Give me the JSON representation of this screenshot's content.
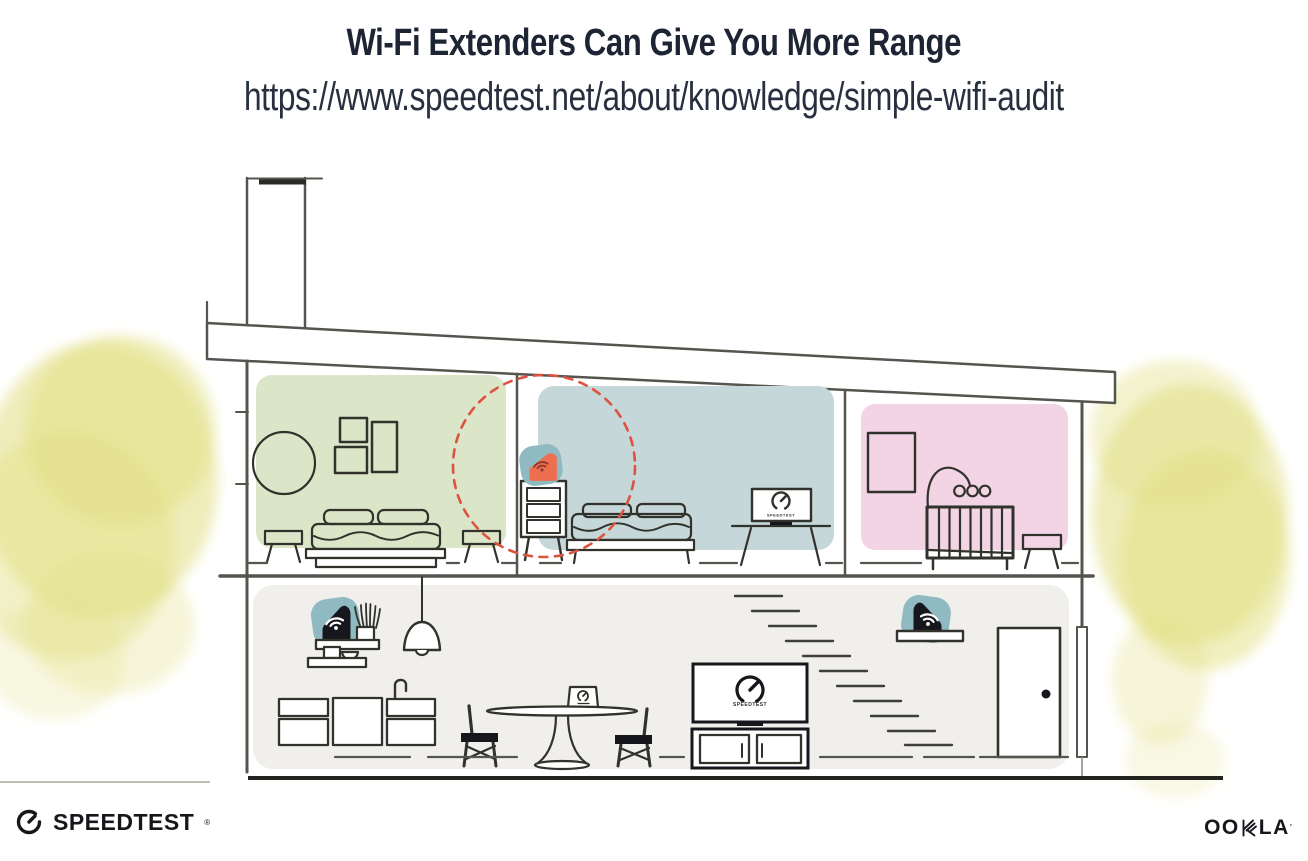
{
  "header": {
    "title": "Wi-Fi Extenders Can Give You More Range",
    "url": "https://www.speedtest.net/about/knowledge/simple-wifi-audit"
  },
  "scene": {
    "bedroom_tv_label": "SPEEDTEST",
    "living_tv_label": "SPEEDTEST"
  },
  "footer": {
    "speedtest_wordmark": "SPEEDTEST",
    "speedtest_reg": "®",
    "ookla_left": "OO",
    "ookla_right": "LA",
    "ookla_tm": "’"
  },
  "colors": {
    "title_ink": "#1d2433",
    "url_ink": "#28303f",
    "line": "#55554f",
    "ink": "#32322c",
    "black": "#16171c",
    "room_green": "#dbe5c8",
    "room_blue": "#c5d7d9",
    "room_pink": "#f3d4e4",
    "floor_gray": "#f0efec",
    "device_teal": "#8fbac1",
    "extender_orange": "#ee6e50",
    "wifi_on_orange": "#8d3a28",
    "range_red": "#dd5340",
    "tree_yellow": "#e2df82",
    "logo_ink": "#16171b"
  }
}
